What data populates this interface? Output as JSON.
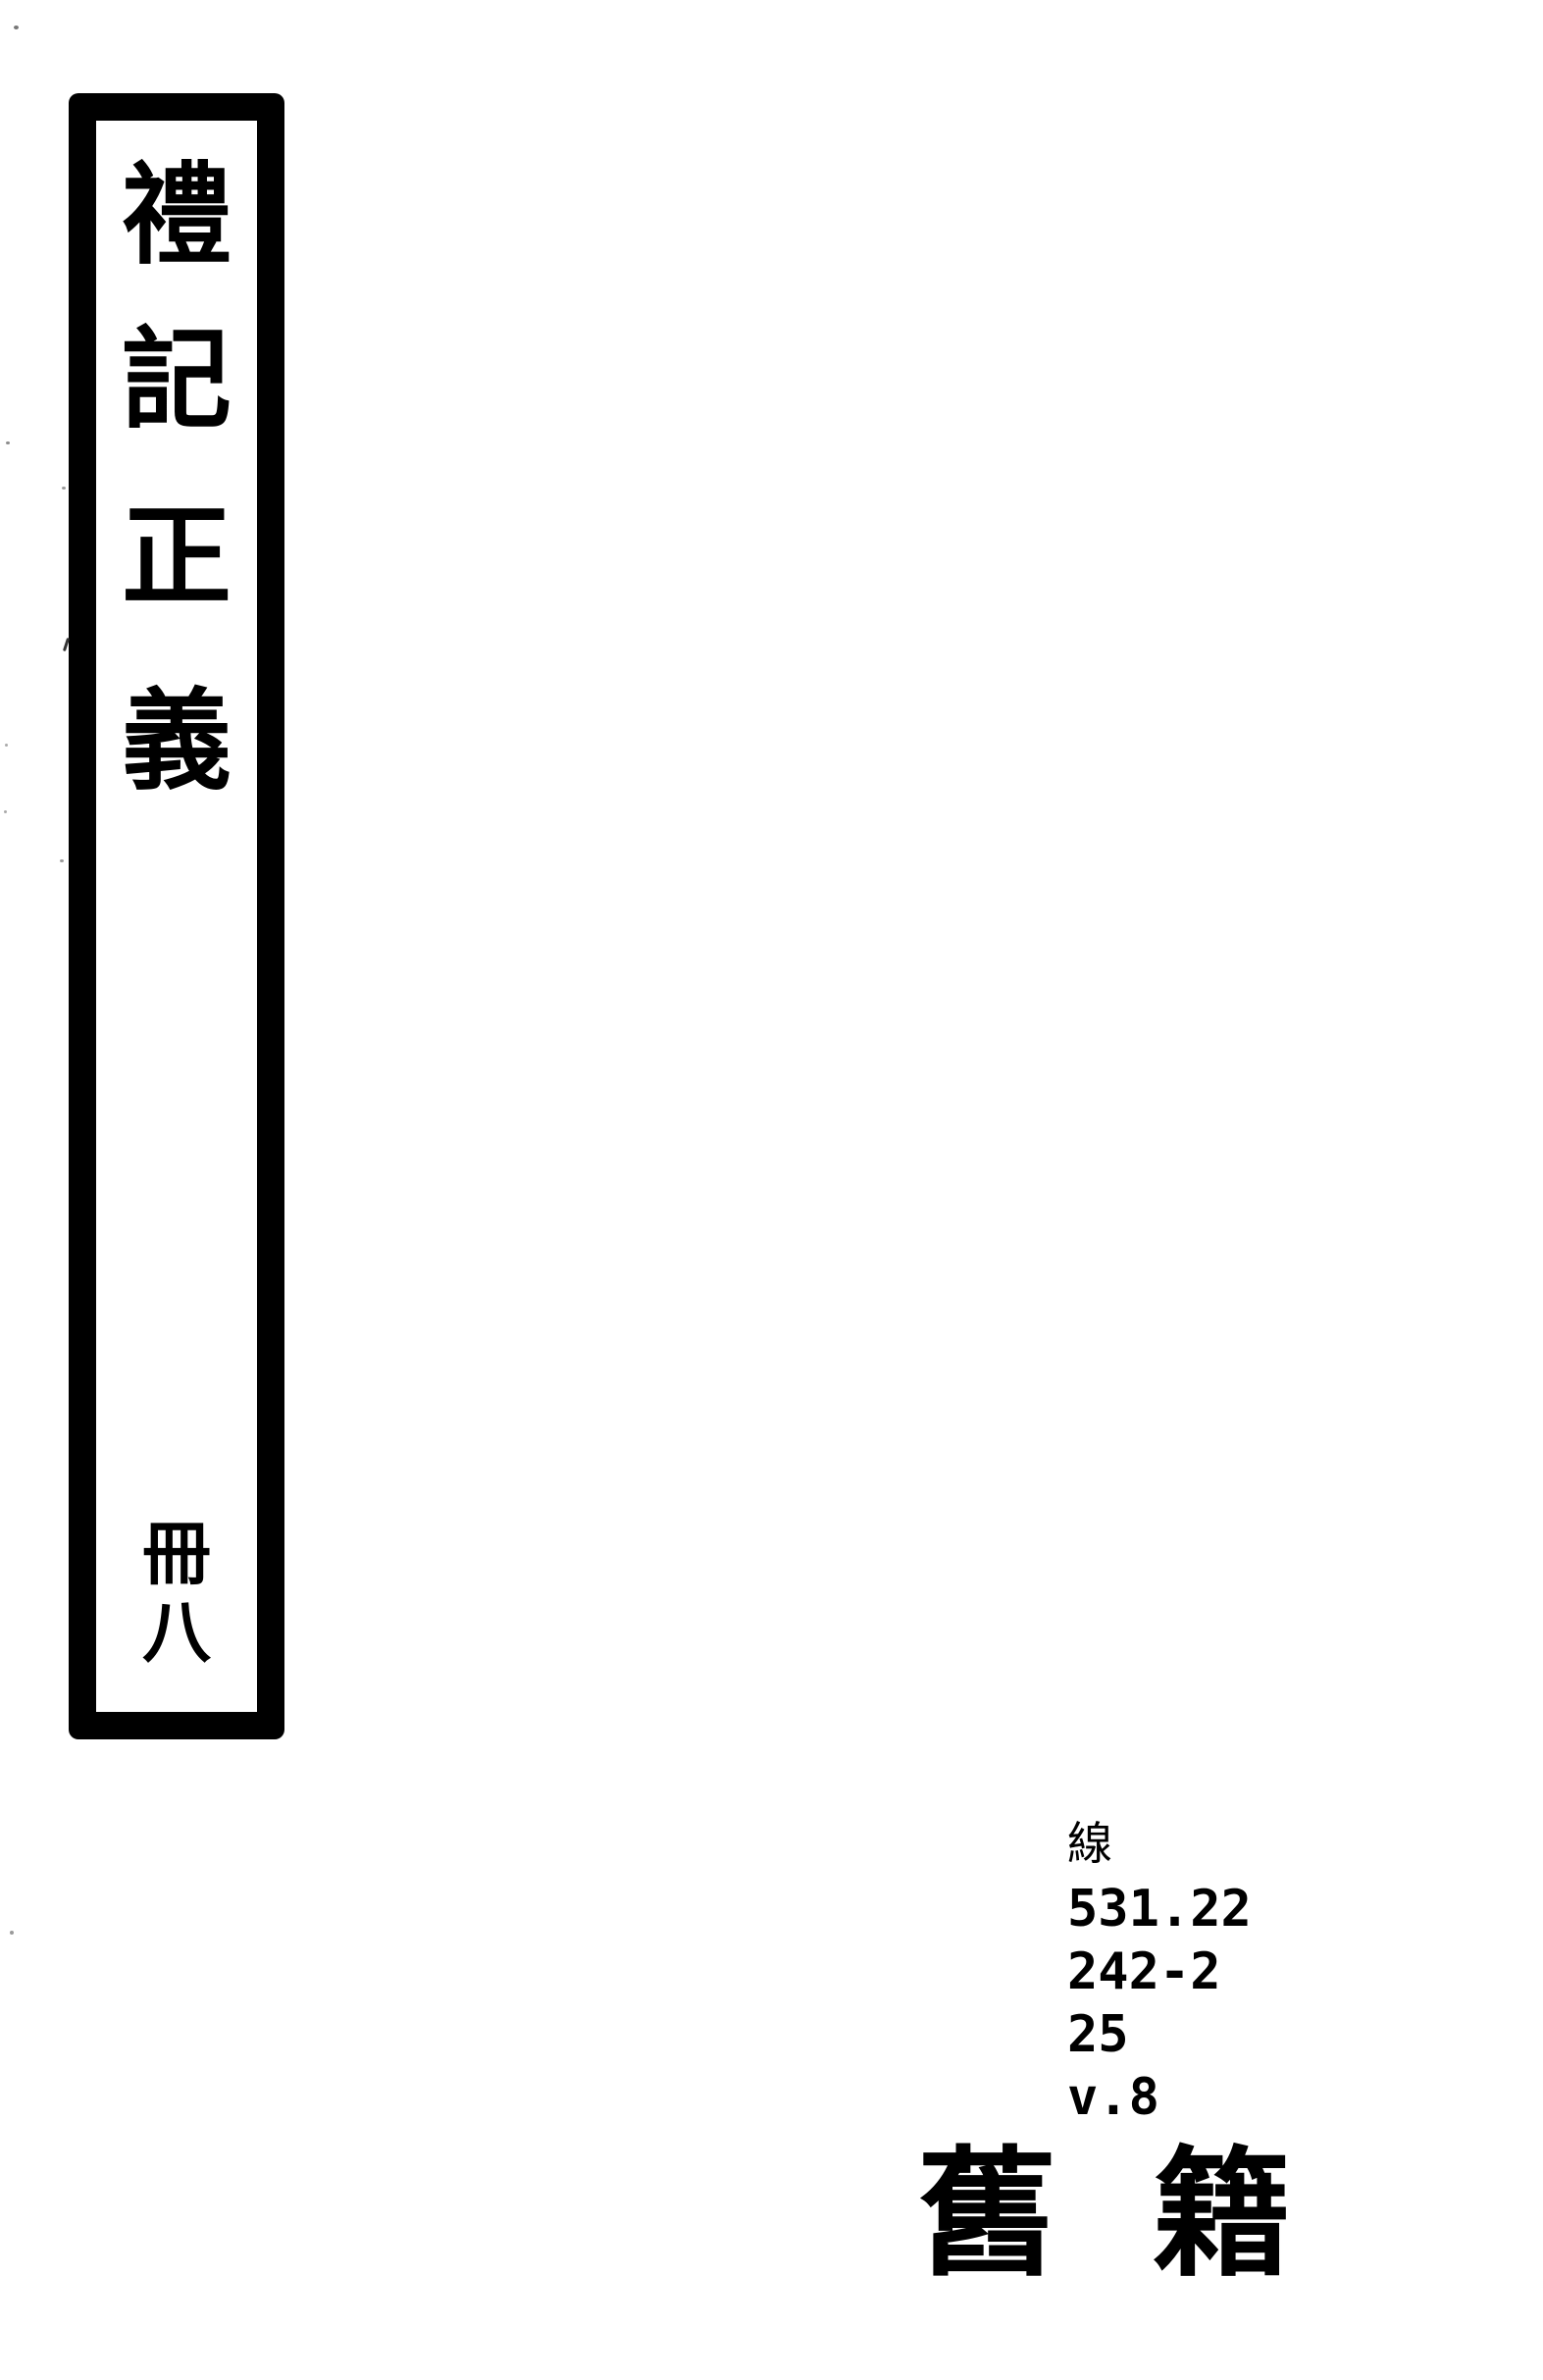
{
  "page": {
    "background_color": "#ffffff",
    "ink_color": "#000000"
  },
  "spine_label": {
    "title_text": "禮記正義",
    "title_characters": [
      "禮",
      "記",
      "正",
      "義"
    ],
    "volume_text": "冊八",
    "volume_characters": [
      "冊",
      "八"
    ]
  },
  "call_number": {
    "prefix": "線",
    "lines": [
      "531.22",
      "242-2",
      "25",
      "v.8"
    ]
  },
  "collection_label": {
    "text": "舊籍",
    "characters": [
      "舊",
      "籍"
    ]
  }
}
